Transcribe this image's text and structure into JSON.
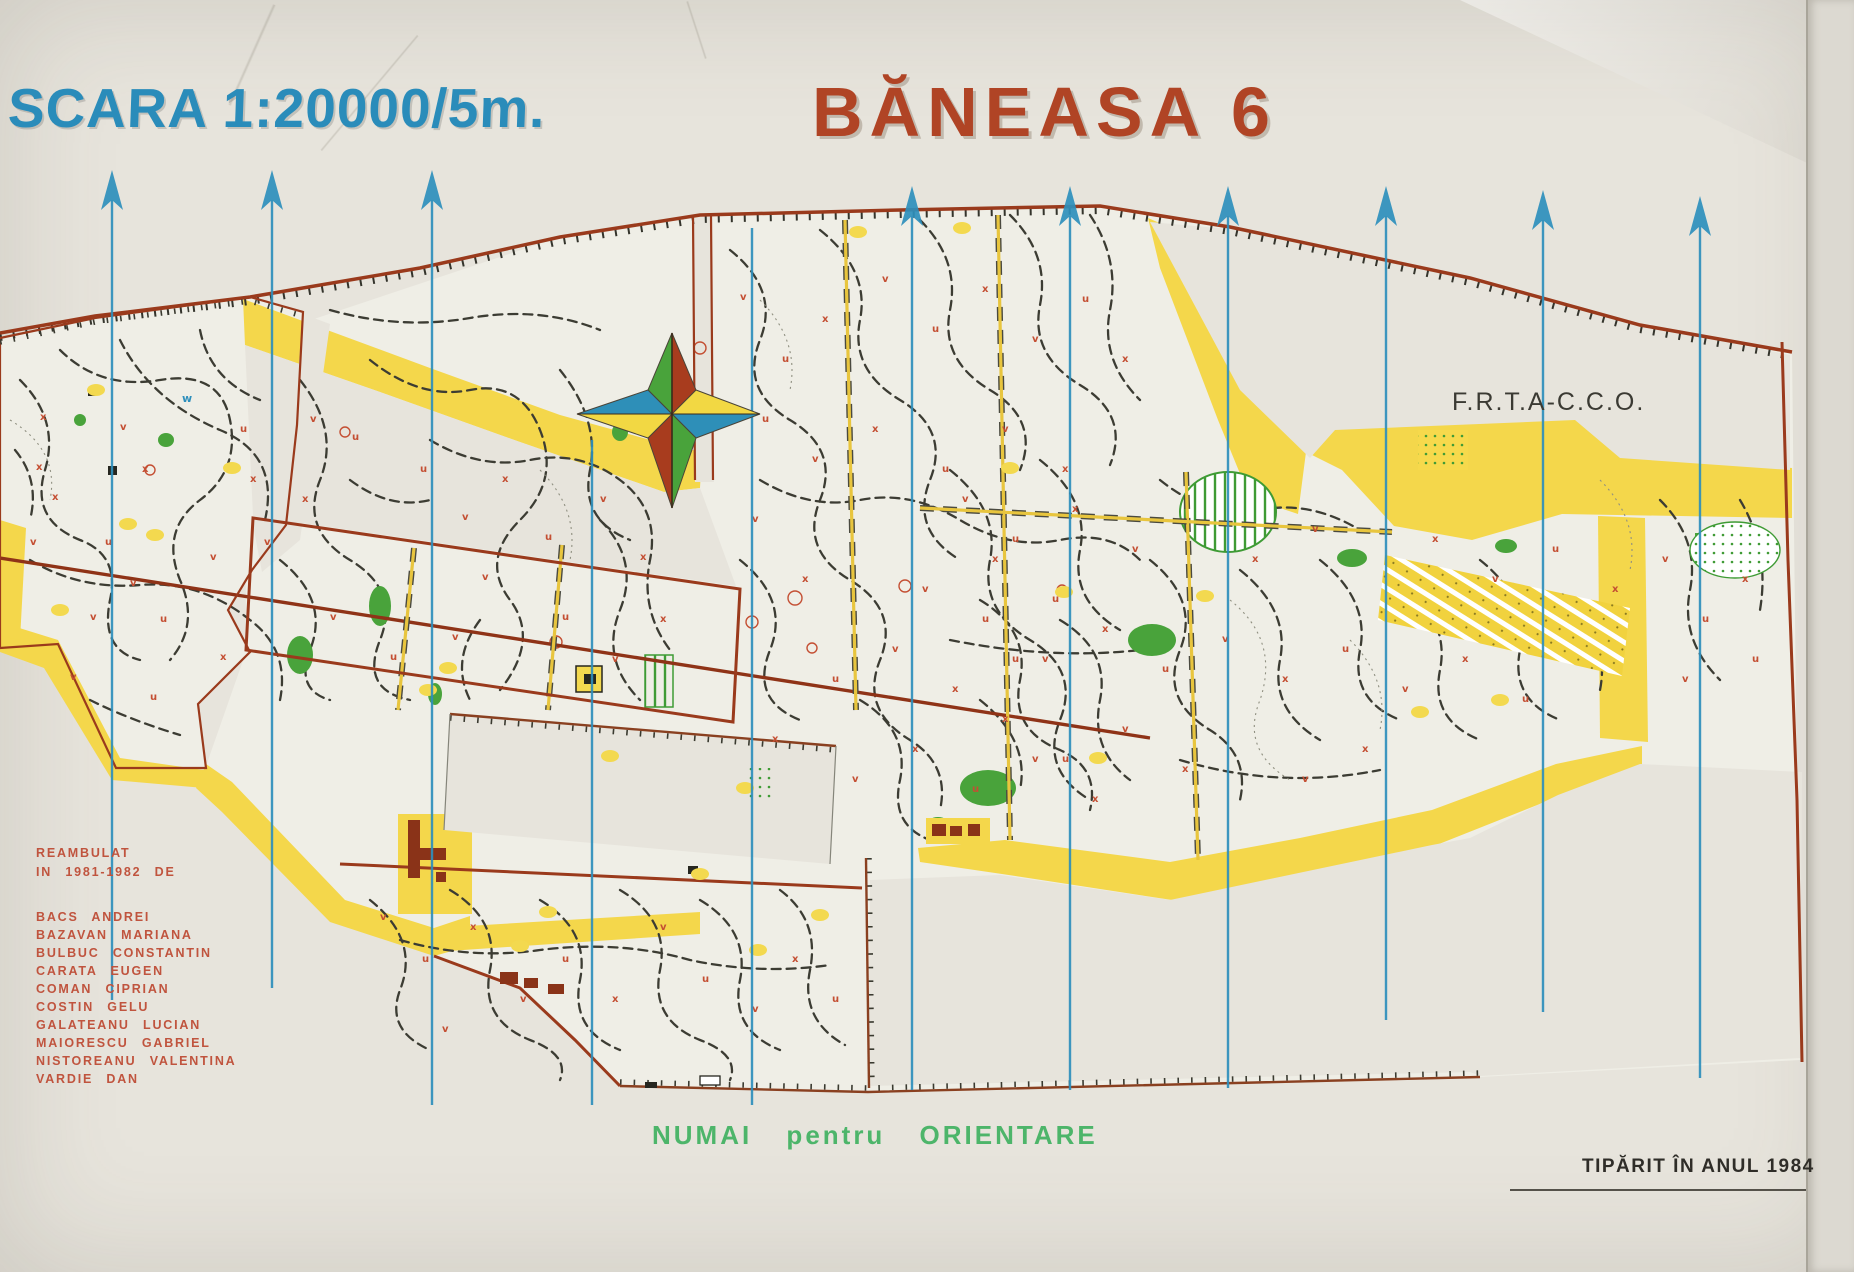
{
  "header": {
    "scale_title": "SCARA 1:20000/5m.",
    "map_title": "BĂNEASA 6",
    "scale_title_color": "#2a8cba",
    "map_title_color": "#b04425"
  },
  "organization": {
    "label": "F.R.T.A-C.C.O."
  },
  "credits": {
    "heading_line1": "REAMBULAT",
    "heading_line2": "IN 1981-1982 DE",
    "color": "#c0543e",
    "names": [
      "BACS ANDREI",
      "BAZAVAN MARIANA",
      "BULBUC CONSTANTIN",
      "CARATA EUGEN",
      "COMAN CIPRIAN",
      "COSTIN GELU",
      "GALATEANU LUCIAN",
      "MAIORESCU GABRIEL",
      "NISTOREANU VALENTINA",
      "VARDIE DAN"
    ]
  },
  "footer": {
    "usage_note": {
      "text": "NUMAI pentru ORIENTARE",
      "color": "#4db56a"
    },
    "print_note": {
      "text": "TIPĂRIT ÎN ANUL 1984",
      "color": "#2f2d28"
    }
  },
  "compass": {
    "type": "four-point-star",
    "colors": {
      "green": "#49a33b",
      "red": "#a83c1e",
      "blue": "#2e8fb8",
      "yellow": "#f2d843"
    }
  },
  "map": {
    "colors": {
      "paper": "#e7e4dc",
      "map_body": "#efeee6",
      "open_yellow": "#f4d74b",
      "forest_green": "#49a33b",
      "border_brown": "#9a3a1c",
      "trail_black": "#3c3c33",
      "meridian_blue": "#2e8fbc",
      "symbol_red": "#c44f33"
    },
    "meridians": [
      [
        112,
        170,
        1000,
        true
      ],
      [
        272,
        170,
        988,
        true
      ],
      [
        432,
        170,
        1105,
        true
      ],
      [
        592,
        440,
        1105,
        false
      ],
      [
        752,
        228,
        1105,
        false
      ],
      [
        912,
        186,
        1090,
        true
      ],
      [
        1070,
        186,
        1090,
        true
      ],
      [
        1228,
        186,
        1088,
        true
      ],
      [
        1386,
        186,
        1020,
        true
      ],
      [
        1543,
        190,
        1012,
        true
      ],
      [
        1700,
        196,
        1078,
        true
      ]
    ],
    "yellow_patches": [
      [
        96,
        390
      ],
      [
        128,
        524
      ],
      [
        232,
        468
      ],
      [
        428,
        690
      ],
      [
        448,
        668
      ],
      [
        520,
        946
      ],
      [
        548,
        912
      ],
      [
        610,
        756
      ],
      [
        700,
        874
      ],
      [
        745,
        788
      ],
      [
        858,
        232
      ],
      [
        962,
        228
      ],
      [
        1010,
        468
      ],
      [
        1064,
        592
      ],
      [
        1098,
        758
      ],
      [
        1205,
        596
      ],
      [
        1420,
        712
      ],
      [
        758,
        950
      ],
      [
        820,
        915
      ],
      [
        1500,
        700
      ],
      [
        60,
        610
      ],
      [
        155,
        535
      ]
    ],
    "red_marks": [
      [
        40,
        420,
        "x"
      ],
      [
        52,
        500,
        "x"
      ],
      [
        30,
        545,
        "v"
      ],
      [
        120,
        430,
        "v"
      ],
      [
        142,
        472,
        "x"
      ],
      [
        90,
        620,
        "v"
      ],
      [
        160,
        622,
        "u"
      ],
      [
        210,
        560,
        "v"
      ],
      [
        240,
        432,
        "u"
      ],
      [
        70,
        680,
        "v"
      ],
      [
        150,
        700,
        "u"
      ],
      [
        250,
        482,
        "x"
      ],
      [
        264,
        545,
        "v"
      ],
      [
        220,
        660,
        "x"
      ],
      [
        36,
        470,
        "x"
      ],
      [
        130,
        586,
        "v"
      ],
      [
        105,
        545,
        "u"
      ],
      [
        310,
        422,
        "v"
      ],
      [
        352,
        440,
        "u"
      ],
      [
        302,
        502,
        "x"
      ],
      [
        420,
        472,
        "u"
      ],
      [
        462,
        520,
        "v"
      ],
      [
        502,
        482,
        "x"
      ],
      [
        545,
        540,
        "u"
      ],
      [
        600,
        502,
        "v"
      ],
      [
        640,
        560,
        "x"
      ],
      [
        330,
        620,
        "v"
      ],
      [
        390,
        660,
        "u"
      ],
      [
        452,
        640,
        "v"
      ],
      [
        562,
        620,
        "u"
      ],
      [
        612,
        662,
        "v"
      ],
      [
        660,
        622,
        "x"
      ],
      [
        482,
        580,
        "v"
      ],
      [
        380,
        920,
        "v"
      ],
      [
        422,
        962,
        "u"
      ],
      [
        470,
        930,
        "x"
      ],
      [
        520,
        1002,
        "v"
      ],
      [
        562,
        962,
        "u"
      ],
      [
        612,
        1002,
        "x"
      ],
      [
        660,
        930,
        "v"
      ],
      [
        702,
        982,
        "u"
      ],
      [
        752,
        1012,
        "v"
      ],
      [
        792,
        962,
        "x"
      ],
      [
        832,
        1002,
        "u"
      ],
      [
        442,
        1032,
        "v"
      ],
      [
        740,
        300,
        "v"
      ],
      [
        782,
        362,
        "u"
      ],
      [
        822,
        322,
        "x"
      ],
      [
        882,
        282,
        "v"
      ],
      [
        932,
        332,
        "u"
      ],
      [
        982,
        292,
        "x"
      ],
      [
        1032,
        342,
        "v"
      ],
      [
        1082,
        302,
        "u"
      ],
      [
        1122,
        362,
        "x"
      ],
      [
        762,
        422,
        "u"
      ],
      [
        812,
        462,
        "v"
      ],
      [
        872,
        432,
        "x"
      ],
      [
        942,
        472,
        "u"
      ],
      [
        1002,
        432,
        "v"
      ],
      [
        1062,
        472,
        "x"
      ],
      [
        922,
        592,
        "v"
      ],
      [
        992,
        562,
        "x"
      ],
      [
        1052,
        602,
        "u"
      ],
      [
        832,
        682,
        "u"
      ],
      [
        892,
        652,
        "v"
      ],
      [
        952,
        692,
        "x"
      ],
      [
        1012,
        662,
        "u"
      ],
      [
        772,
        742,
        "x"
      ],
      [
        852,
        782,
        "v"
      ],
      [
        912,
        752,
        "x"
      ],
      [
        972,
        792,
        "u"
      ],
      [
        1032,
        762,
        "v"
      ],
      [
        1092,
        802,
        "x"
      ],
      [
        752,
        522,
        "v"
      ],
      [
        802,
        582,
        "x"
      ],
      [
        962,
        502,
        "v"
      ],
      [
        1012,
        542,
        "u"
      ],
      [
        1072,
        512,
        "x"
      ],
      [
        1132,
        552,
        "v"
      ],
      [
        1252,
        562,
        "x"
      ],
      [
        1312,
        532,
        "v"
      ],
      [
        1432,
        542,
        "x"
      ],
      [
        1492,
        582,
        "v"
      ],
      [
        1552,
        552,
        "u"
      ],
      [
        1612,
        592,
        "x"
      ],
      [
        982,
        622,
        "u"
      ],
      [
        1042,
        662,
        "v"
      ],
      [
        1102,
        632,
        "x"
      ],
      [
        1162,
        672,
        "u"
      ],
      [
        1222,
        642,
        "v"
      ],
      [
        1282,
        682,
        "x"
      ],
      [
        1342,
        652,
        "u"
      ],
      [
        1402,
        692,
        "v"
      ],
      [
        1462,
        662,
        "x"
      ],
      [
        1522,
        702,
        "u"
      ],
      [
        1002,
        722,
        "x"
      ],
      [
        1062,
        762,
        "u"
      ],
      [
        1122,
        732,
        "v"
      ],
      [
        1182,
        772,
        "x"
      ],
      [
        1302,
        782,
        "v"
      ],
      [
        1362,
        752,
        "x"
      ],
      [
        1662,
        562,
        "v"
      ],
      [
        1702,
        622,
        "u"
      ],
      [
        1742,
        582,
        "x"
      ],
      [
        1682,
        682,
        "v"
      ],
      [
        1752,
        662,
        "u"
      ]
    ]
  }
}
